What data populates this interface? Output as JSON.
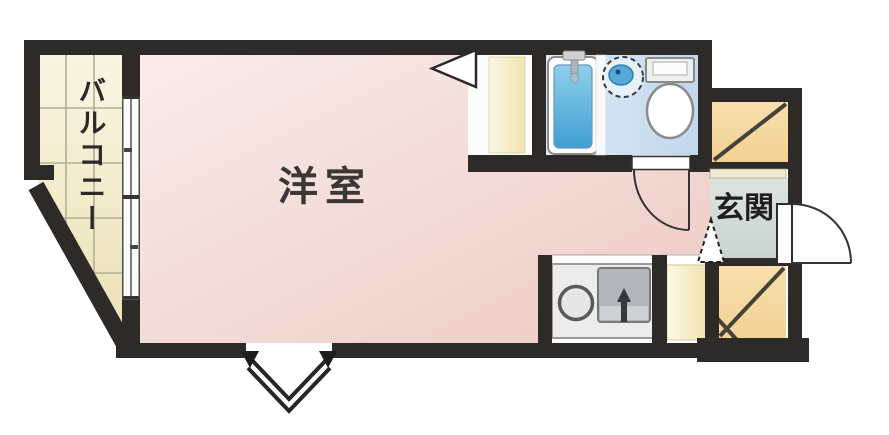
{
  "figure": {
    "type": "floor-plan",
    "description": "Japanese studio apartment floor plan (1R) with western room, balcony, bathroom, kitchenette and entrance"
  },
  "rooms": {
    "western_room": {
      "label": "洋室"
    },
    "balcony": {
      "label": "バルコニー"
    },
    "entrance": {
      "label": "玄関"
    }
  },
  "fixtures": {
    "bathtub": "bathtub-icon",
    "washbasin": "washbasin-icon",
    "toilet": "toilet-icon",
    "stove_burner": "stove-burner-icon",
    "kitchen_sink": "kitchen-sink-icon",
    "closet_upper": "closet-diagonal-icon",
    "closet_lower": "closet-double-diagonal-icon",
    "storage_column": "storage-column",
    "entrance_door": "door-swing-icon",
    "bathroom_door": "door-swing-icon",
    "closet_door_marker": "triangle-door-icon",
    "step_up_marker": "dashed-triangle-step-icon",
    "balcony_window": "sliding-window-icon",
    "south_window": "chevron-window-icon"
  },
  "colors": {
    "wall": "#2d2a27",
    "room_pink": "#f3d9d5",
    "balcony_cream": "#f4eec9",
    "bathroom_blue": "#cfe0f0",
    "bathtub_blue": "#53abdc",
    "entrance_gray": "#d2dbd7",
    "closet_tan": "#f6d9a2",
    "closet_cream": "#f6ecc4",
    "kitchen_gray": "#ececea"
  }
}
